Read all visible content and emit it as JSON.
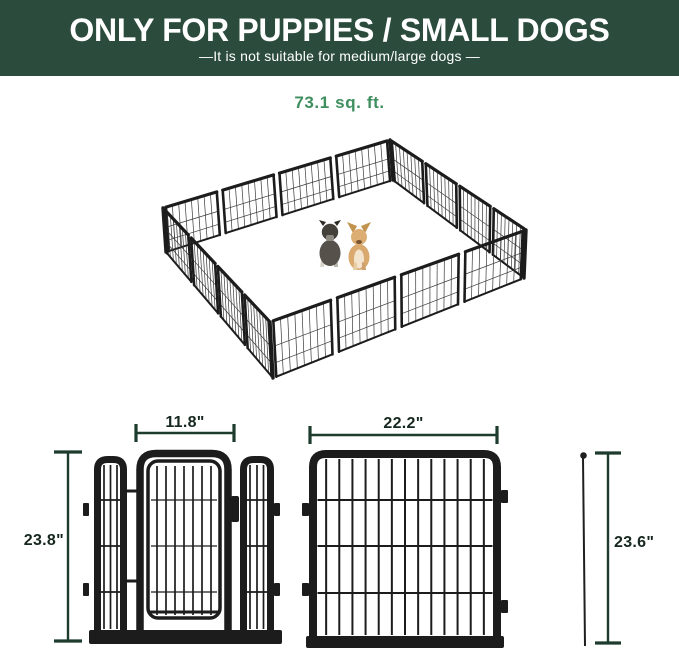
{
  "banner": {
    "title": "ONLY FOR PUPPIES / SMALL DOGS",
    "subtitle": "—It is not suitable for medium/large dogs —",
    "bg_color": "#2b4c3d",
    "text_color": "#ffffff"
  },
  "playpen_illustration": {
    "area_label": "73.1 sq. ft.",
    "area_label_color": "#3e8e5e",
    "fence_color": "#1c1c1c",
    "dogs": [
      "schnauzer-puppy",
      "chihuahua"
    ]
  },
  "dimension_diagram": {
    "line_color": "#1d3c2e",
    "text_color": "#15271e",
    "labels": {
      "gate_door_width": "11.8\"",
      "gate_panel_height": "23.8\"",
      "large_panel_width": "22.2\"",
      "ground_stake_height": "23.6\""
    }
  }
}
